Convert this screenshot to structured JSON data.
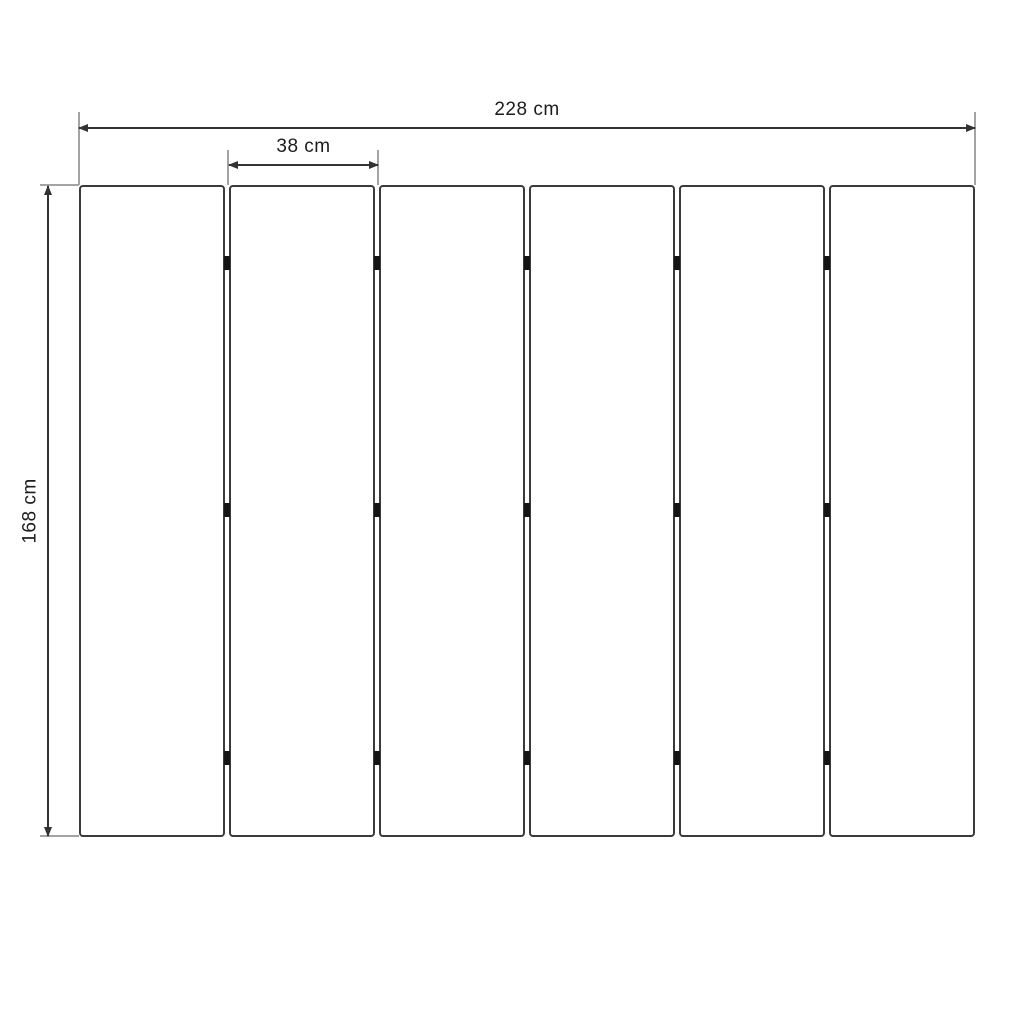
{
  "diagram": {
    "type": "technical-drawing",
    "unit": "cm",
    "panel_count": 6,
    "hinge_positions_pct": [
      12,
      49.8,
      87.9
    ],
    "dimensions": {
      "total_width": {
        "value": 228,
        "label": "228 cm"
      },
      "panel_width": {
        "value": 38,
        "label": "38 cm"
      },
      "height": {
        "value": 168,
        "label": "168 cm"
      }
    },
    "colors": {
      "panel_border": "#3b3b3b",
      "dimension_line": "#323232",
      "extension_line": "#a3a3a3",
      "hinge": "#141414",
      "background": "#ffffff",
      "text": "#1c1c1c"
    }
  }
}
